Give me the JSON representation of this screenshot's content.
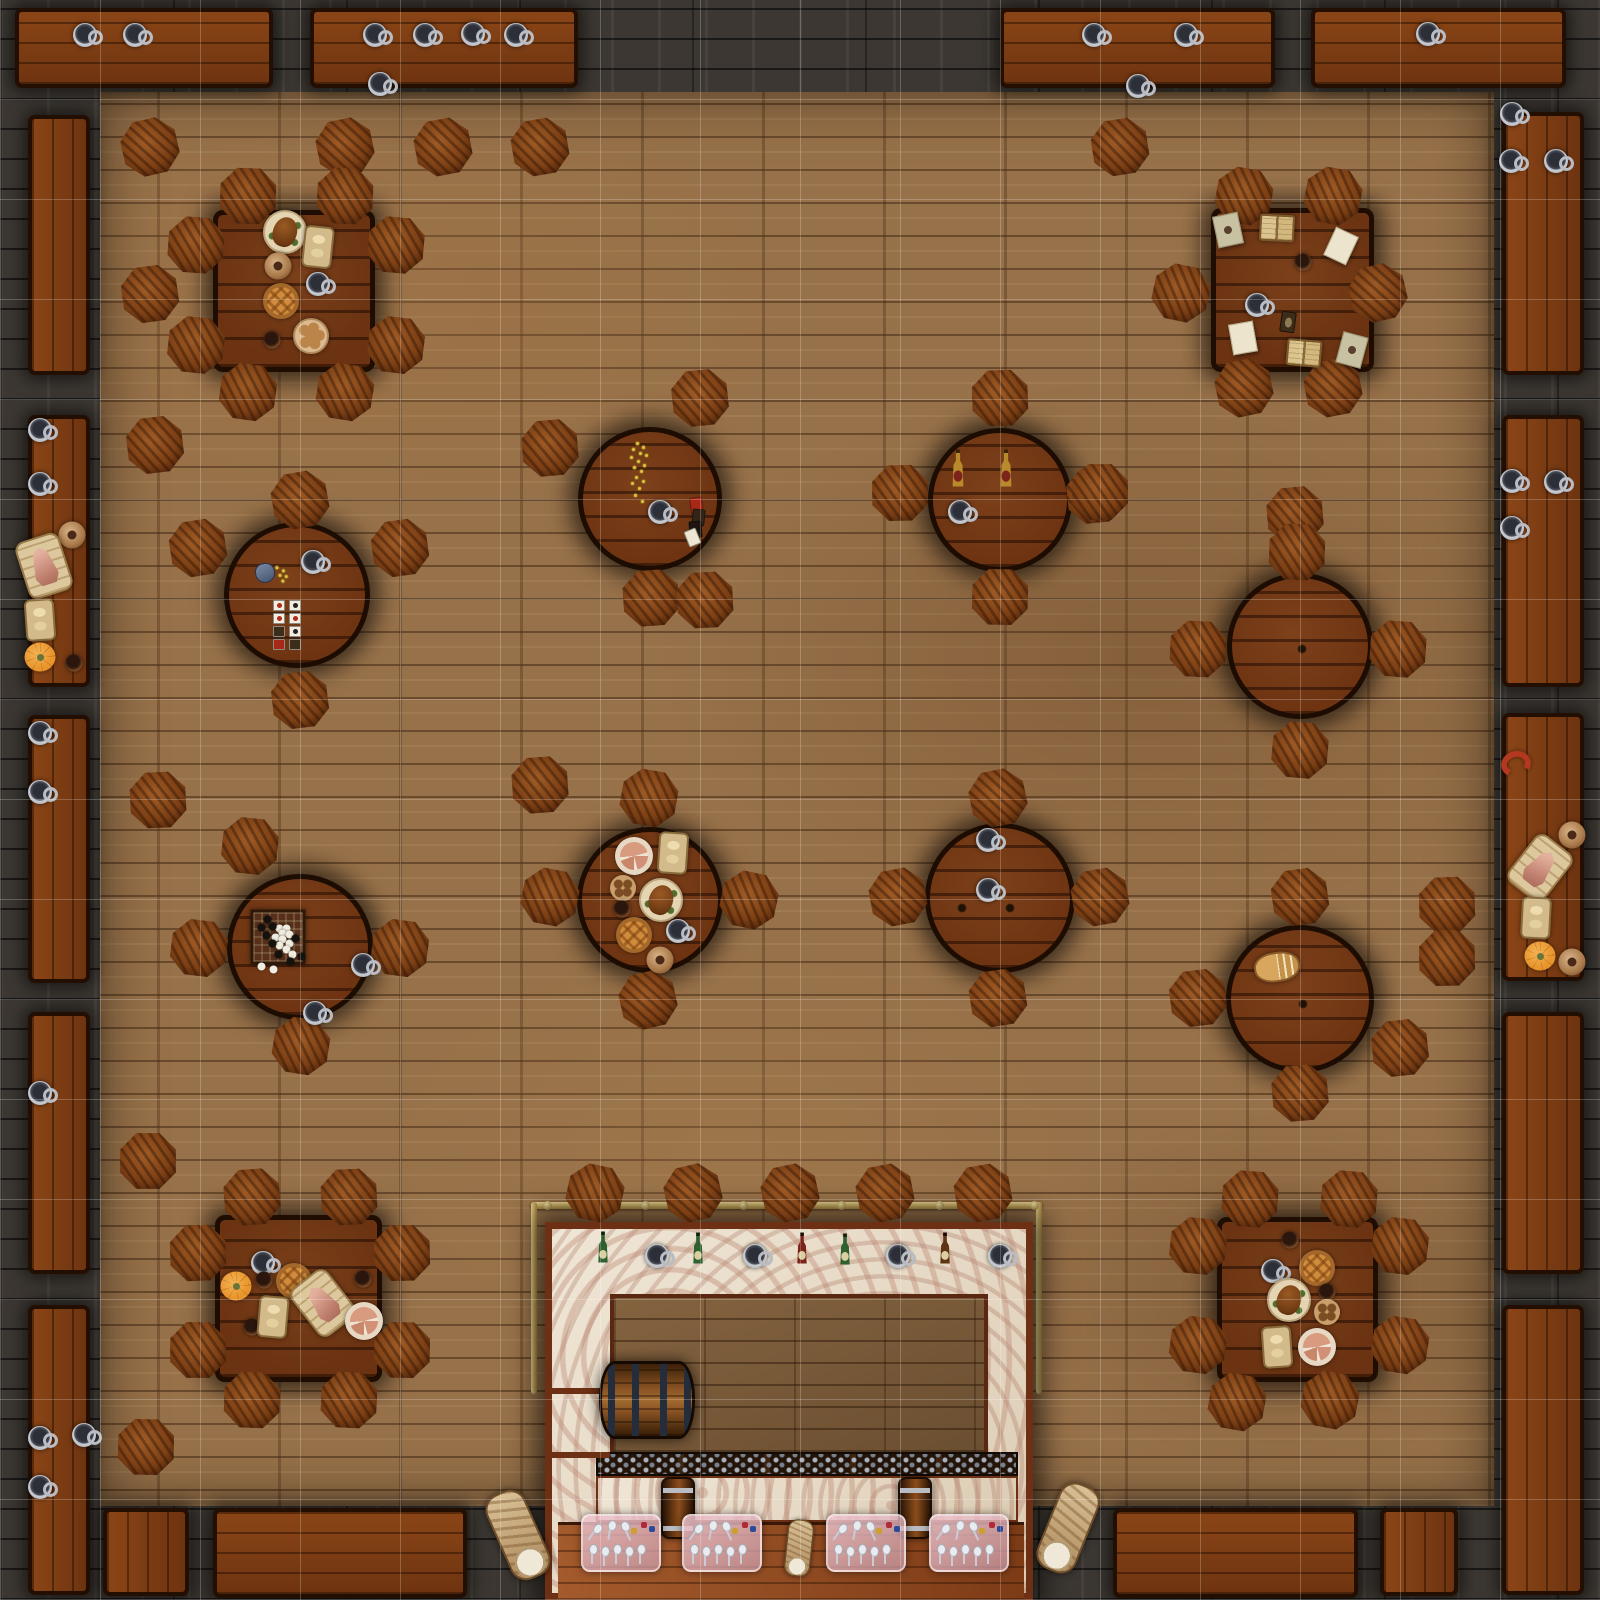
{
  "map": {
    "width": 1600,
    "height": 1600,
    "palette": {
      "wall": "#3c3732",
      "floor": "#977149",
      "bench_wood": "#7c3c12",
      "table_wood": "#6b3312",
      "stool_wood": "#7c3f14",
      "marble": "#e9ddca",
      "brass": "#caa952",
      "grid_line": "rgba(255,255,255,0.22)"
    },
    "grid": {
      "cell": 100,
      "cols": 16,
      "rows": 16
    },
    "floor_rect": {
      "x": 100,
      "y": 92,
      "w": 1394,
      "h": 1414
    },
    "benches": [
      {
        "x": 15,
        "y": 8,
        "w": 258,
        "h": 80
      },
      {
        "x": 310,
        "y": 8,
        "w": 268,
        "h": 80
      },
      {
        "x": 1000,
        "y": 8,
        "w": 275,
        "h": 80
      },
      {
        "x": 1311,
        "y": 8,
        "w": 255,
        "h": 80
      },
      {
        "x": 28,
        "y": 115,
        "w": 62,
        "h": 260
      },
      {
        "x": 28,
        "y": 415,
        "w": 62,
        "h": 272
      },
      {
        "x": 28,
        "y": 715,
        "w": 62,
        "h": 268
      },
      {
        "x": 28,
        "y": 1012,
        "w": 62,
        "h": 262
      },
      {
        "x": 28,
        "y": 1305,
        "w": 62,
        "h": 290
      },
      {
        "x": 1502,
        "y": 112,
        "w": 82,
        "h": 263
      },
      {
        "x": 1502,
        "y": 415,
        "w": 82,
        "h": 272
      },
      {
        "x": 1502,
        "y": 713,
        "w": 82,
        "h": 268
      },
      {
        "x": 1502,
        "y": 1012,
        "w": 82,
        "h": 262
      },
      {
        "x": 1502,
        "y": 1305,
        "w": 82,
        "h": 290
      },
      {
        "x": 103,
        "y": 1508,
        "w": 86,
        "h": 88
      },
      {
        "x": 213,
        "y": 1508,
        "w": 254,
        "h": 90
      },
      {
        "x": 1113,
        "y": 1508,
        "w": 245,
        "h": 90
      },
      {
        "x": 1380,
        "y": 1508,
        "w": 78,
        "h": 88
      }
    ],
    "square_tables": [
      {
        "x": 213,
        "y": 210,
        "w": 162,
        "h": 162
      },
      {
        "x": 1211,
        "y": 208,
        "w": 163,
        "h": 164
      },
      {
        "x": 215,
        "y": 1215,
        "w": 167,
        "h": 167
      },
      {
        "x": 1217,
        "y": 1217,
        "w": 161,
        "h": 165
      }
    ],
    "round_tables": [
      {
        "cx": 297,
        "cy": 595,
        "r": 73
      },
      {
        "cx": 650,
        "cy": 499,
        "r": 72
      },
      {
        "cx": 1000,
        "cy": 500,
        "r": 72
      },
      {
        "cx": 1300,
        "cy": 646,
        "r": 73
      },
      {
        "cx": 300,
        "cy": 947,
        "r": 73
      },
      {
        "cx": 650,
        "cy": 900,
        "r": 73
      },
      {
        "cx": 1000,
        "cy": 898,
        "r": 75
      },
      {
        "cx": 1300,
        "cy": 999,
        "r": 74
      }
    ],
    "stools": [
      [
        150,
        147
      ],
      [
        345,
        147
      ],
      [
        443,
        147
      ],
      [
        540,
        147
      ],
      [
        1120,
        147
      ],
      [
        150,
        294
      ],
      [
        155,
        445
      ],
      [
        1095,
        495
      ],
      [
        1295,
        515
      ],
      [
        540,
        785
      ],
      [
        158,
        800
      ],
      [
        1447,
        905
      ],
      [
        1447,
        958
      ],
      [
        148,
        1161
      ],
      [
        146,
        1447
      ],
      [
        248,
        196
      ],
      [
        345,
        196
      ],
      [
        196,
        245
      ],
      [
        396,
        245
      ],
      [
        196,
        345
      ],
      [
        396,
        345
      ],
      [
        248,
        392
      ],
      [
        345,
        392
      ],
      [
        1244,
        196
      ],
      [
        1333,
        196
      ],
      [
        1181,
        293
      ],
      [
        1378,
        293
      ],
      [
        1244,
        388
      ],
      [
        1333,
        388
      ],
      [
        300,
        500
      ],
      [
        198,
        548
      ],
      [
        400,
        548
      ],
      [
        300,
        700
      ],
      [
        700,
        398
      ],
      [
        550,
        448
      ],
      [
        651,
        598
      ],
      [
        705,
        600
      ],
      [
        1000,
        398
      ],
      [
        900,
        493
      ],
      [
        1100,
        492
      ],
      [
        1000,
        597
      ],
      [
        1297,
        552
      ],
      [
        1198,
        649
      ],
      [
        1398,
        649
      ],
      [
        1300,
        750
      ],
      [
        250,
        846
      ],
      [
        199,
        948
      ],
      [
        400,
        948
      ],
      [
        301,
        1046
      ],
      [
        649,
        798
      ],
      [
        550,
        897
      ],
      [
        749,
        900
      ],
      [
        648,
        1000
      ],
      [
        998,
        798
      ],
      [
        898,
        897
      ],
      [
        1100,
        897
      ],
      [
        998,
        998
      ],
      [
        1300,
        897
      ],
      [
        1198,
        998
      ],
      [
        1400,
        1048
      ],
      [
        1300,
        1093
      ],
      [
        252,
        1197
      ],
      [
        349,
        1197
      ],
      [
        198,
        1253
      ],
      [
        402,
        1253
      ],
      [
        198,
        1350
      ],
      [
        402,
        1350
      ],
      [
        252,
        1400
      ],
      [
        349,
        1400
      ],
      [
        1250,
        1199
      ],
      [
        1349,
        1199
      ],
      [
        1198,
        1246
      ],
      [
        1400,
        1246
      ],
      [
        1198,
        1345
      ],
      [
        1400,
        1345
      ],
      [
        1237,
        1402
      ],
      [
        1330,
        1400
      ],
      [
        595,
        1193
      ],
      [
        693,
        1193
      ],
      [
        790,
        1193
      ],
      [
        885,
        1193
      ],
      [
        983,
        1193
      ]
    ],
    "bar": {
      "rail": {
        "x": 531,
        "y": 1202,
        "w": 511,
        "h": 7
      },
      "rail_drops": [
        {
          "x": 531,
          "y": 1202,
          "w": 6,
          "h": 192
        },
        {
          "x": 1036,
          "y": 1202,
          "w": 6,
          "h": 192
        }
      ],
      "posts": [
        [
          543,
          1201
        ],
        [
          641,
          1201
        ],
        [
          739,
          1201
        ],
        [
          837,
          1201
        ],
        [
          935,
          1201
        ],
        [
          1030,
          1201
        ]
      ],
      "frame": {
        "x": 545,
        "y": 1222,
        "w": 488,
        "h": 378
      },
      "inner": {
        "x": 610,
        "y": 1294,
        "w": 378,
        "h": 162
      },
      "rack": {
        "x": 596,
        "y": 1452,
        "w": 422,
        "h": 24
      },
      "band": {
        "x": 596,
        "y": 1476,
        "w": 422,
        "h": 46
      },
      "bottom": {
        "x": 558,
        "y": 1522,
        "w": 466,
        "h": 78
      },
      "shelves": [
        {
          "x": 548,
          "y": 1388,
          "w": 62,
          "h": 6
        },
        {
          "x": 548,
          "y": 1452,
          "w": 62,
          "h": 6
        }
      ]
    },
    "items": [
      {
        "t": "mug",
        "x": 85,
        "y": 35
      },
      {
        "t": "mug",
        "x": 135,
        "y": 35
      },
      {
        "t": "mug",
        "x": 375,
        "y": 35
      },
      {
        "t": "mug",
        "x": 425,
        "y": 35
      },
      {
        "t": "mug",
        "x": 473,
        "y": 34
      },
      {
        "t": "mug",
        "x": 516,
        "y": 35
      },
      {
        "t": "mug",
        "x": 380,
        "y": 84
      },
      {
        "t": "mug",
        "x": 1094,
        "y": 35
      },
      {
        "t": "mug",
        "x": 1186,
        "y": 35
      },
      {
        "t": "mug",
        "x": 1138,
        "y": 86
      },
      {
        "t": "mug",
        "x": 1428,
        "y": 34
      },
      {
        "t": "mug",
        "x": 1512,
        "y": 114
      },
      {
        "t": "mug",
        "x": 1511,
        "y": 161
      },
      {
        "t": "mug",
        "x": 1556,
        "y": 161
      },
      {
        "t": "mug",
        "x": 1512,
        "y": 481
      },
      {
        "t": "mug",
        "x": 1556,
        "y": 482
      },
      {
        "t": "mug",
        "x": 1512,
        "y": 528
      },
      {
        "t": "sausage-links",
        "x": 1516,
        "y": 764,
        "r": -15
      },
      {
        "t": "pitcher",
        "x": 1572,
        "y": 835
      },
      {
        "t": "ham-cutting-board",
        "x": 1540,
        "y": 868,
        "r": 38
      },
      {
        "t": "bread-board",
        "x": 1536,
        "y": 918,
        "r": 3
      },
      {
        "t": "pumpkin",
        "x": 1540,
        "y": 956
      },
      {
        "t": "pitcher",
        "x": 1572,
        "y": 962
      },
      {
        "t": "mug",
        "x": 40,
        "y": 430
      },
      {
        "t": "mug",
        "x": 40,
        "y": 484
      },
      {
        "t": "pitcher",
        "x": 72,
        "y": 535
      },
      {
        "t": "ham-cutting-board",
        "x": 44,
        "y": 566,
        "r": -18
      },
      {
        "t": "bread-board",
        "x": 40,
        "y": 620,
        "r": -4
      },
      {
        "t": "pumpkin",
        "x": 40,
        "y": 657
      },
      {
        "t": "cup",
        "x": 74,
        "y": 663
      },
      {
        "t": "mug",
        "x": 40,
        "y": 733
      },
      {
        "t": "mug",
        "x": 40,
        "y": 792
      },
      {
        "t": "mug",
        "x": 40,
        "y": 1093
      },
      {
        "t": "mug",
        "x": 40,
        "y": 1438
      },
      {
        "t": "mug",
        "x": 84,
        "y": 1435
      },
      {
        "t": "mug",
        "x": 40,
        "y": 1487
      },
      {
        "t": "roast-platter",
        "x": 285,
        "y": 232
      },
      {
        "t": "bread-board",
        "x": 318,
        "y": 247,
        "r": 6
      },
      {
        "t": "pitcher",
        "x": 278,
        "y": 266
      },
      {
        "t": "mug",
        "x": 318,
        "y": 284
      },
      {
        "t": "lattice-pie",
        "x": 281,
        "y": 301
      },
      {
        "t": "cup",
        "x": 272,
        "y": 340
      },
      {
        "t": "bread-rolls-plate",
        "x": 311,
        "y": 336
      },
      {
        "t": "sealed-note",
        "x": 1228,
        "y": 230,
        "r": -12
      },
      {
        "t": "open-book",
        "x": 1277,
        "y": 228,
        "r": 3
      },
      {
        "t": "parchment",
        "x": 1341,
        "y": 246,
        "r": 25
      },
      {
        "t": "cup",
        "x": 1303,
        "y": 262
      },
      {
        "t": "mug",
        "x": 1257,
        "y": 305
      },
      {
        "t": "playing-card",
        "x": 1288,
        "y": 322,
        "r": 8
      },
      {
        "t": "parchment",
        "x": 1243,
        "y": 338,
        "r": -10
      },
      {
        "t": "open-book",
        "x": 1304,
        "y": 353,
        "r": 5
      },
      {
        "t": "sealed-note",
        "x": 1352,
        "y": 350,
        "r": 15
      },
      {
        "t": "coin-pouch",
        "x": 272,
        "y": 572,
        "r": -8
      },
      {
        "t": "mug",
        "x": 313,
        "y": 562
      },
      {
        "t": "card-spread",
        "x": 288,
        "y": 625
      },
      {
        "t": "coin-scatter",
        "x": 637,
        "y": 472
      },
      {
        "t": "mug",
        "x": 660,
        "y": 512
      },
      {
        "t": "card-pile",
        "x": 697,
        "y": 520
      },
      {
        "t": "tall-bottle",
        "x": 958,
        "y": 468
      },
      {
        "t": "tall-bottle",
        "x": 1006,
        "y": 468
      },
      {
        "t": "mug",
        "x": 960,
        "y": 512
      },
      {
        "t": "knot",
        "x": 1302,
        "y": 649
      },
      {
        "t": "go-board",
        "x": 278,
        "y": 937
      },
      {
        "t": "mug",
        "x": 363,
        "y": 965
      },
      {
        "t": "mug",
        "x": 315,
        "y": 1013
      },
      {
        "t": "sliced-pie-plate",
        "x": 634,
        "y": 856
      },
      {
        "t": "bread-board",
        "x": 673,
        "y": 853,
        "r": 4
      },
      {
        "t": "cookie-plate",
        "x": 623,
        "y": 888
      },
      {
        "t": "roast-platter",
        "x": 661,
        "y": 900
      },
      {
        "t": "cup",
        "x": 622,
        "y": 909
      },
      {
        "t": "lattice-pie",
        "x": 634,
        "y": 935
      },
      {
        "t": "mug",
        "x": 678,
        "y": 931
      },
      {
        "t": "pitcher",
        "x": 660,
        "y": 960
      },
      {
        "t": "mug",
        "x": 988,
        "y": 840
      },
      {
        "t": "mug",
        "x": 988,
        "y": 890
      },
      {
        "t": "knot",
        "x": 962,
        "y": 908
      },
      {
        "t": "knot",
        "x": 1010,
        "y": 908
      },
      {
        "t": "sliced-bread",
        "x": 1277,
        "y": 967,
        "r": -8
      },
      {
        "t": "knot",
        "x": 1303,
        "y": 1004
      },
      {
        "t": "mug",
        "x": 263,
        "y": 1263
      },
      {
        "t": "cup",
        "x": 264,
        "y": 1280
      },
      {
        "t": "pumpkin",
        "x": 236,
        "y": 1286
      },
      {
        "t": "lattice-pie",
        "x": 294,
        "y": 1281
      },
      {
        "t": "ham-cutting-board",
        "x": 323,
        "y": 1303,
        "r": -38
      },
      {
        "t": "cup",
        "x": 363,
        "y": 1279
      },
      {
        "t": "cup",
        "x": 252,
        "y": 1327
      },
      {
        "t": "bread-board",
        "x": 273,
        "y": 1317,
        "r": 5
      },
      {
        "t": "sliced-pie-plate",
        "x": 364,
        "y": 1321
      },
      {
        "t": "cup",
        "x": 1290,
        "y": 1240
      },
      {
        "t": "mug",
        "x": 1273,
        "y": 1271
      },
      {
        "t": "lattice-pie",
        "x": 1317,
        "y": 1268
      },
      {
        "t": "roast-platter",
        "x": 1289,
        "y": 1300
      },
      {
        "t": "cup",
        "x": 1327,
        "y": 1292
      },
      {
        "t": "cookie-plate",
        "x": 1327,
        "y": 1312
      },
      {
        "t": "bread-board",
        "x": 1277,
        "y": 1347,
        "r": -4
      },
      {
        "t": "sliced-pie-plate",
        "x": 1317,
        "y": 1347
      },
      {
        "t": "wine-bottle-green",
        "x": 603,
        "y": 1247
      },
      {
        "t": "mug",
        "x": 657,
        "y": 1256
      },
      {
        "t": "wine-bottle-green",
        "x": 698,
        "y": 1248
      },
      {
        "t": "mug",
        "x": 755,
        "y": 1256
      },
      {
        "t": "wine-bottle-red",
        "x": 802,
        "y": 1248
      },
      {
        "t": "wine-bottle-green",
        "x": 845,
        "y": 1249
      },
      {
        "t": "mug",
        "x": 898,
        "y": 1256
      },
      {
        "t": "wine-bottle-brown",
        "x": 945,
        "y": 1248
      },
      {
        "t": "mug",
        "x": 1000,
        "y": 1256
      },
      {
        "t": "beer-barrel",
        "x": 647,
        "y": 1400
      },
      {
        "t": "keg",
        "x": 678,
        "y": 1508
      },
      {
        "t": "keg",
        "x": 915,
        "y": 1508
      },
      {
        "t": "cutlery-tray",
        "x": 621,
        "y": 1543
      },
      {
        "t": "cutlery-tray",
        "x": 722,
        "y": 1543
      },
      {
        "t": "cutlery-tray",
        "x": 866,
        "y": 1543
      },
      {
        "t": "cutlery-tray",
        "x": 969,
        "y": 1543
      },
      {
        "t": "log",
        "x": 518,
        "y": 1535,
        "r": -24
      },
      {
        "t": "log",
        "x": 799,
        "y": 1548,
        "r": 6,
        "s": 0.62
      },
      {
        "t": "log",
        "x": 1068,
        "y": 1528,
        "r": 22
      }
    ]
  }
}
